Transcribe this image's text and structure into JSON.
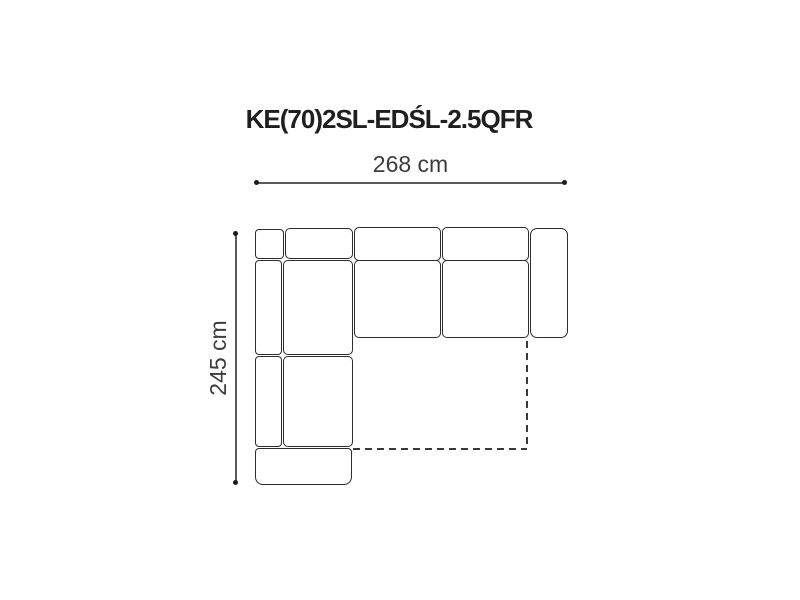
{
  "diagram": {
    "title": "KE(70)2SL-EDŚL-2.5QFR",
    "type": "corner-sofa-top-view-dimension-drawing",
    "dimensions": {
      "width": {
        "value": 268,
        "unit": "cm",
        "label": "268 cm"
      },
      "depth": {
        "value": 245,
        "unit": "cm",
        "label": "245 cm"
      }
    },
    "colors": {
      "outline": "#2d2d2d",
      "dimension_line": "#5a5a5a",
      "dashed_line": "#3a3a3a",
      "title_text": "#1f1f1f",
      "dimension_text": "#3c3c3c",
      "background": "#ffffff"
    },
    "parts": [
      "corner-back-cushion",
      "back-cushion-over-corner-seat",
      "back-cushion-middle",
      "back-cushion-right",
      "right-armrest",
      "seat-cushion-middle",
      "seat-cushion-right",
      "left-back-cushion-upper",
      "corner-seat-cushion",
      "left-back-cushion-lower",
      "left-seat-cushion",
      "front-armrest",
      "fold-out-bed-dashed-outline"
    ]
  }
}
